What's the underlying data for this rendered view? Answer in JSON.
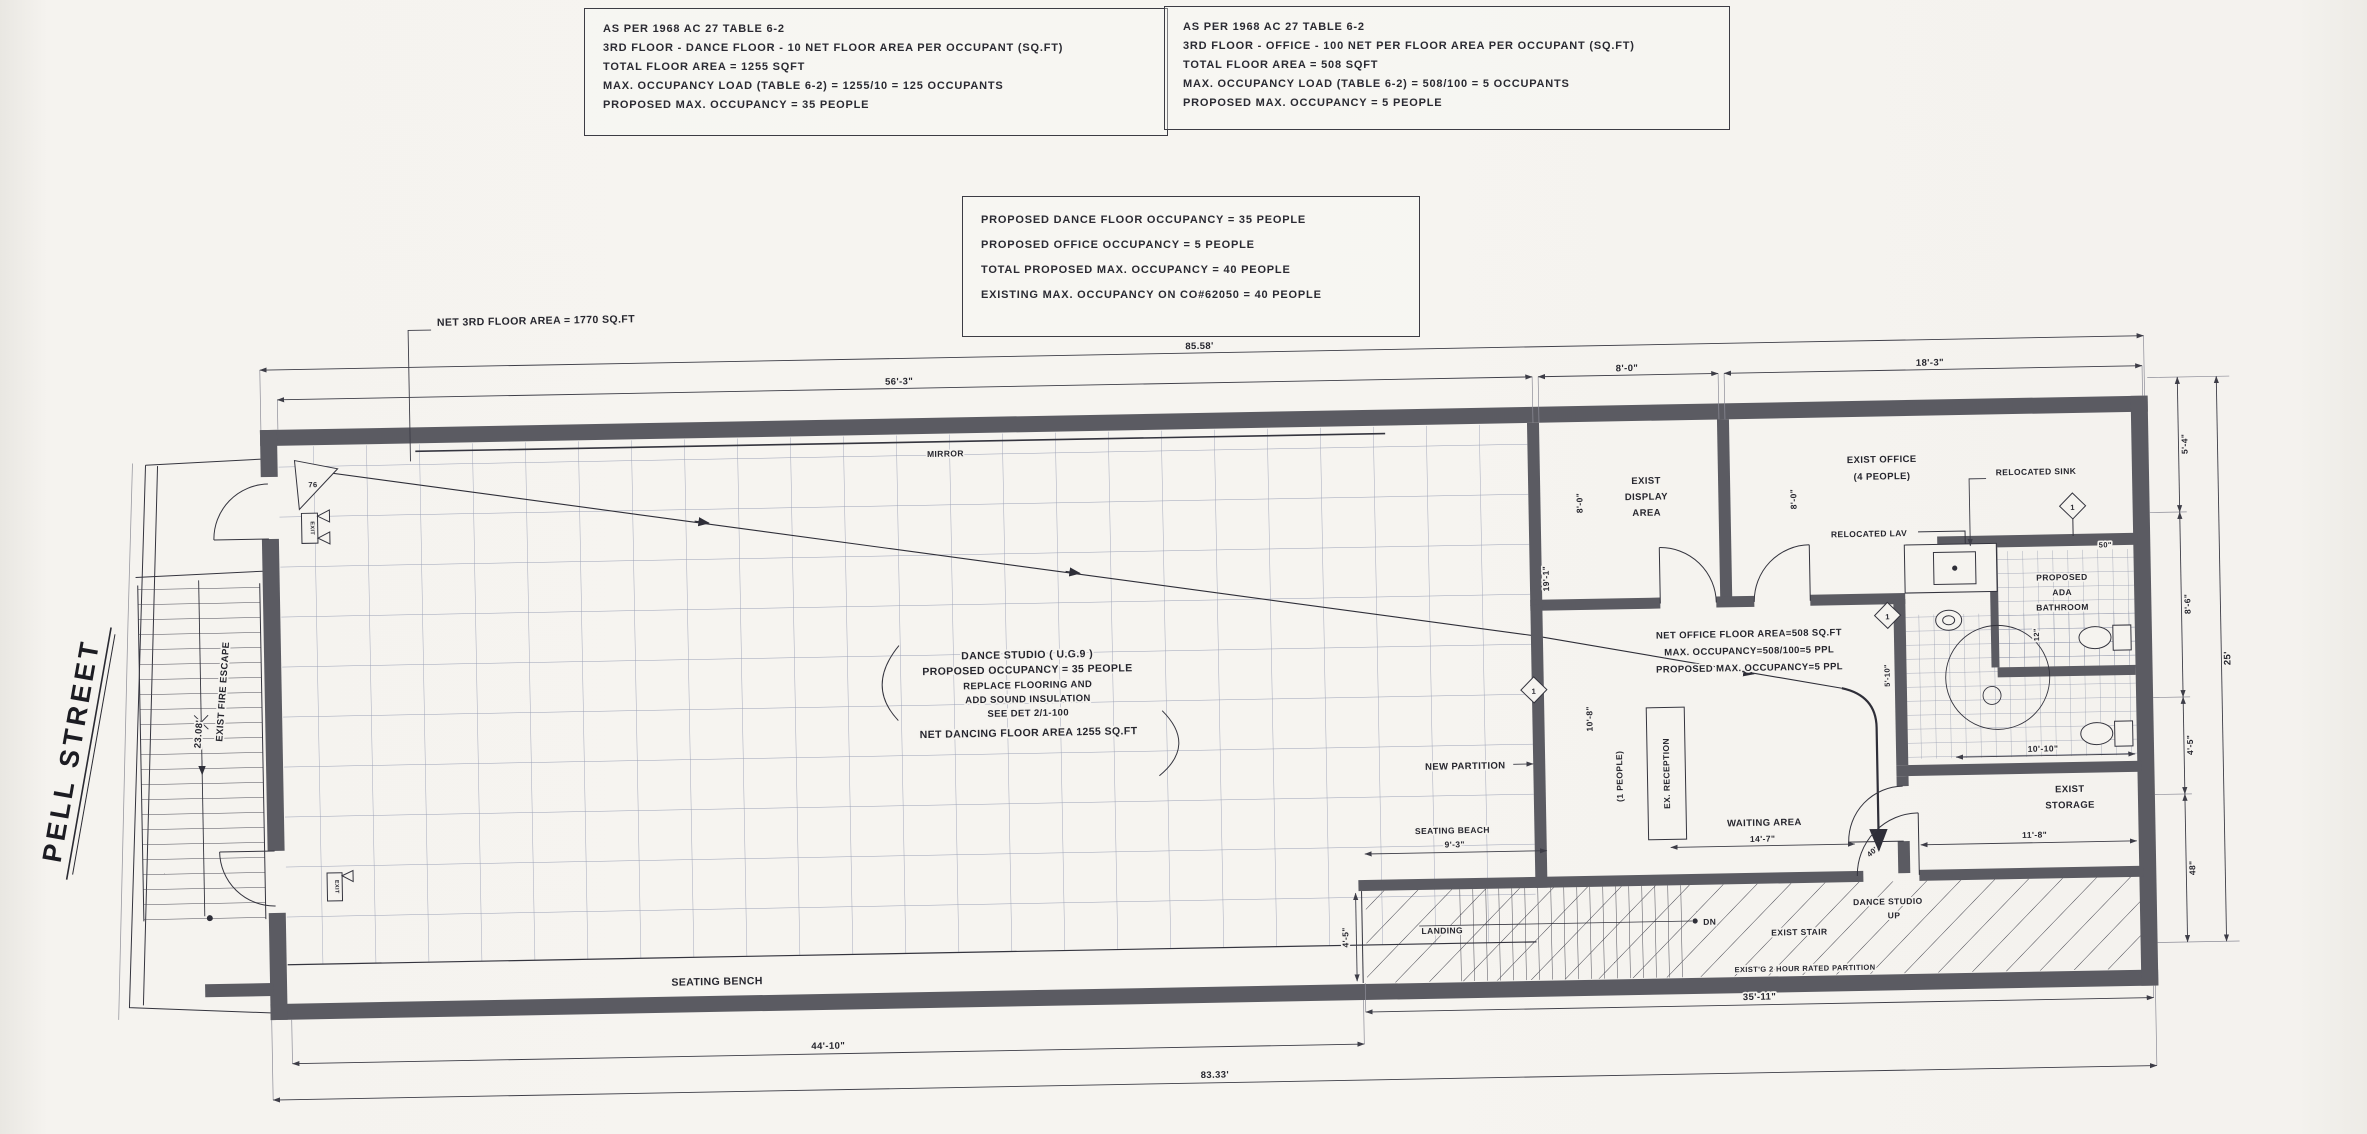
{
  "page": {
    "background": "#f5f3ef",
    "ink": "#2b2b33",
    "wall_color": "#5b5b62"
  },
  "note_box_dance": {
    "lines": [
      "AS PER 1968 AC 27 TABLE 6-2",
      "3RD FLOOR - DANCE FLOOR - 10 NET FLOOR AREA PER OCCUPANT (SQ.FT)",
      "TOTAL FLOOR AREA = 1255 SQFT",
      "MAX. OCCUPANCY LOAD (TABLE 6-2) = 1255/10 = 125 OCCUPANTS",
      "PROPOSED MAX. OCCUPANCY = 35 PEOPLE"
    ]
  },
  "note_box_office": {
    "lines": [
      "AS PER 1968 AC 27 TABLE 6-2",
      "3RD FLOOR - OFFICE - 100 NET PER FLOOR AREA PER OCCUPANT (SQ.FT)",
      "TOTAL FLOOR AREA = 508 SQFT",
      "MAX. OCCUPANCY LOAD (TABLE 6-2) = 508/100 = 5 OCCUPANTS",
      "PROPOSED MAX. OCCUPANCY = 5 PEOPLE"
    ]
  },
  "note_box_summary": {
    "lines": [
      "PROPOSED DANCE FLOOR OCCUPANCY = 35 PEOPLE",
      "PROPOSED OFFICE OCCUPANCY = 5 PEOPLE",
      "TOTAL PROPOSED MAX. OCCUPANCY = 40 PEOPLE",
      "EXISTING MAX. OCCUPANCY ON CO#62050 = 40 PEOPLE"
    ]
  },
  "street": {
    "name": "PELL STREET"
  },
  "studio_note": {
    "l1": "DANCE STUDIO ( U.G.9 )",
    "l2": "PROPOSED OCCUPANCY = 35 PEOPLE",
    "l3": "REPLACE FLOORING AND",
    "l4": "ADD SOUND INSULATION",
    "l5": "SEE DET 2/1-100",
    "l6": "NET DANCING FLOOR AREA  1255 SQ.FT"
  },
  "office_note": {
    "l1": "NET OFFICE FLOOR AREA=508 SQ.FT",
    "l2": "MAX. OCCUPANCY=508/100=5 PPL",
    "l3": "PROPOSED MAX. OCCUPANCY=5 PPL"
  },
  "labels": {
    "net_floor_area": "NET 3RD FLOOR AREA = 1770 SQ.FT",
    "mirror": "MIRROR",
    "seating_bench": "SEATING BENCH",
    "seating_beach": "SEATING BEACH",
    "new_partition": "NEW PARTITION",
    "exist_fire_escape": "EXIST FIRE ESCAPE",
    "fire_escape_length": "23.08'",
    "exist_display_1": "EXIST",
    "exist_display_2": "DISPLAY",
    "exist_display_3": "AREA",
    "exist_office_1": "EXIST OFFICE",
    "exist_office_2": "(4 PEOPLE)",
    "relocated_lav": "RELOCATED LAV",
    "relocated_sink": "RELOCATED SINK",
    "ada_1": "PROPOSED",
    "ada_2": "ADA",
    "ada_3": "BATHROOM",
    "exist_storage_1": "EXIST",
    "exist_storage_2": "STORAGE",
    "waiting_area": "WAITING AREA",
    "ex_reception": "EX. RECEPTION",
    "one_people": "(1 PEOPLE)",
    "landing": "LANDING",
    "dn": "DN",
    "up": "UP",
    "exist_stair": "EXIST STAIR",
    "dance_studio_up": "DANCE STUDIO",
    "rated_partition": "EXIST'G 2 HOUR RATED PARTITION",
    "keynote_76": "76",
    "keynote_1": "1",
    "exit": "EXIT",
    "forty": "40'"
  },
  "dims": {
    "overall_top": "85.58'",
    "studio_top": "56'-3\"",
    "display_top": "8'-0\"",
    "office_top": "18'-3\"",
    "bottom_left": "44'-10\"",
    "overall_bottom": "83.33'",
    "stair_bottom": "35'-11\"",
    "right_1": "5'-4\"",
    "right_2": "8'-6\"",
    "right_3": "4'-5\"",
    "right_4": "48\"",
    "overall_right": "25'",
    "display_depth": "8'-0\"",
    "office_depth": "8'-0\"",
    "studio_side": "19'-1\"",
    "partition_h": "10'-8\"",
    "bath_side": "5'-10\"",
    "bath_width": "10'-10\"",
    "storage_width": "11'-8\"",
    "waiting_width": "14'-7\"",
    "beach_width": "9'-3\"",
    "landing_side": "4'-5\"",
    "twelve": "12\"",
    "fifty": "50\""
  }
}
